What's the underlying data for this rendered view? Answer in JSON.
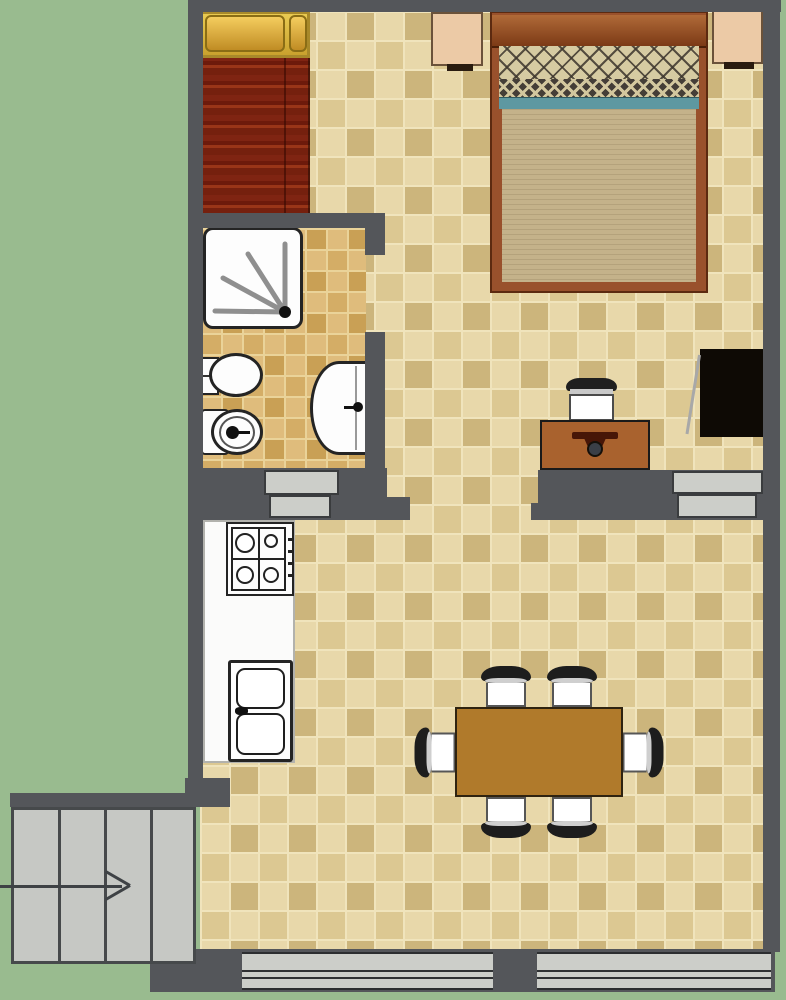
{
  "plan": {
    "type": "apartment floor plan",
    "view": "top-down",
    "rooms": [
      "bedroom",
      "bathroom",
      "kitchen",
      "living-dining area",
      "staircase entry"
    ],
    "fixtures": [
      "single bed",
      "double bed",
      "nightstand left",
      "nightstand right",
      "wardrobe",
      "desk",
      "desk chair",
      "dining table",
      "dining chairs x6",
      "kitchen counter",
      "gas stove",
      "double kitchen sink",
      "shower",
      "toilet",
      "bidet",
      "washbasin",
      "staircase with direction arrow",
      "window bottom left",
      "window bottom right",
      "door threshold bathroom",
      "door threshold balcony"
    ]
  },
  "colors": {
    "outside_green": "#99bb8f",
    "wall_gray": "#54565a",
    "floor_tile_light": "#e8d8aa",
    "floor_tile_dark": "#ccb57c",
    "floor_tile_mid": "#dcc892",
    "floor_grout": "#f0e4bc",
    "bath_tile_light": "#dfbc7c",
    "bath_tile_dark": "#c9a055",
    "bath_tile_mid": "#d4ad66",
    "bath_grout": "#ead399",
    "stair_fill": "#c6c8c4",
    "stair_line": "#46494b",
    "window_fill": "#cccec9",
    "fixture_white": "#fdfdfd",
    "fixture_border": "#242424",
    "single_bed_red_dark": "#78200f",
    "single_bed_red_light": "#a23f1d",
    "single_bed_gold": "#e3c04a",
    "bed_wood": "#99512c",
    "bed_blanket": "#c4b28a",
    "bed_pillow_band": "#d6cba2",
    "bed_pillow_pattern": "#453e37",
    "bed_teal": "#5e98a1",
    "nightstand": "#eccaa6",
    "nightstand_shadow": "#2a1c10",
    "wardrobe_black": "#0e0a05",
    "desk_wood": "#a9622e",
    "desk_drawer": "#471607",
    "table_wood": "#b07a2b",
    "chair_back": "#1d1d1d",
    "chair_seat": "#ffffff",
    "counter_white": "#fbfbfa",
    "arrow": "#3e4245"
  }
}
